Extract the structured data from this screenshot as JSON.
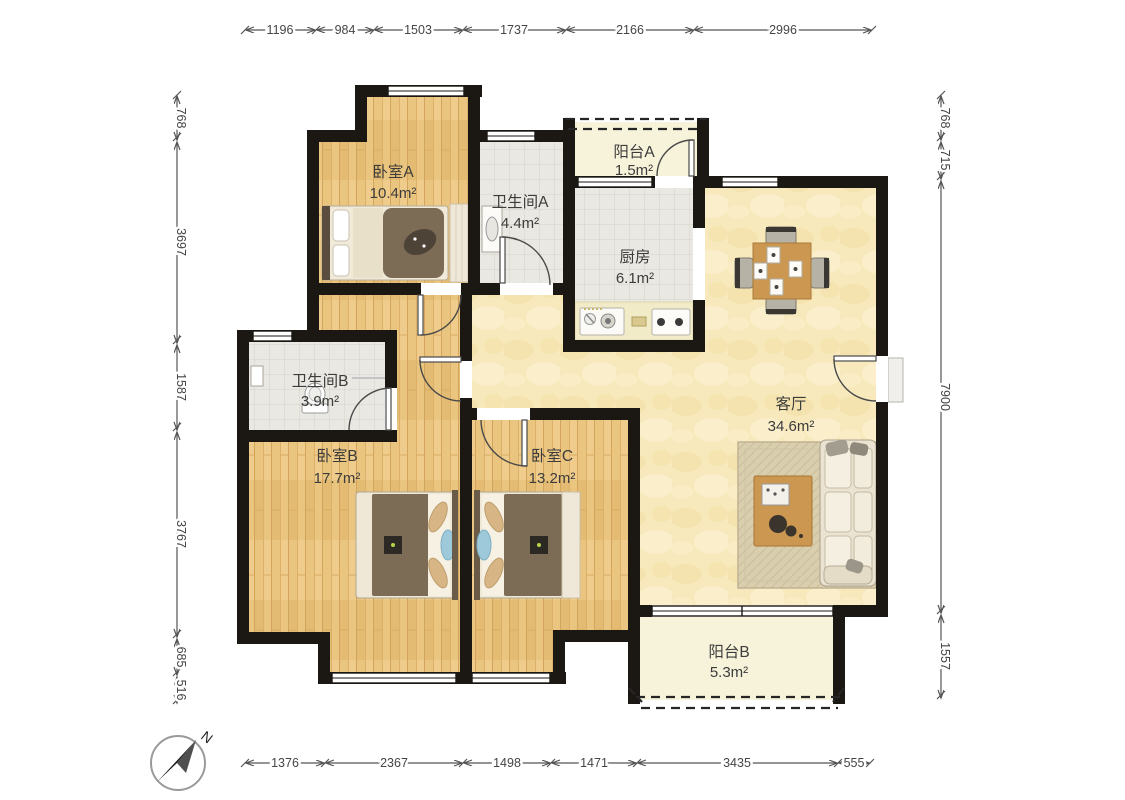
{
  "plan": {
    "type": "apartment-floor-plan",
    "compass": {
      "label": "N"
    },
    "rooms": [
      {
        "id": "bedroom-a",
        "name": "卧室A",
        "area": "10.4m²"
      },
      {
        "id": "bathroom-a",
        "name": "卫生间A",
        "area": "4.4m²"
      },
      {
        "id": "balcony-a",
        "name": "阳台A",
        "area": "1.5m²"
      },
      {
        "id": "kitchen",
        "name": "厨房",
        "area": "6.1m²"
      },
      {
        "id": "living",
        "name": "客厅",
        "area": "34.6m²"
      },
      {
        "id": "bathroom-b",
        "name": "卫生间B",
        "area": "3.9m²"
      },
      {
        "id": "bedroom-b",
        "name": "卧室B",
        "area": "17.7m²"
      },
      {
        "id": "bedroom-c",
        "name": "卧室C",
        "area": "13.2m²"
      },
      {
        "id": "balcony-b",
        "name": "阳台B",
        "area": "5.3m²"
      }
    ],
    "dimensions": {
      "top": [
        "1196",
        "984",
        "1503",
        "1737",
        "2166",
        "2996"
      ],
      "bottom": [
        "1376",
        "2367",
        "1498",
        "1471",
        "3435",
        "555"
      ],
      "left": [
        "768",
        "3697",
        "1587",
        "3767",
        "685",
        "516"
      ],
      "right": [
        "768",
        "715",
        "7900",
        "1557"
      ]
    },
    "colors": {
      "wall": "#1b1713",
      "wood_floor": "#eac57f",
      "living_floor": "#f8e9bd",
      "tile_floor": "#eae8e2",
      "balcony_floor": "#f7f3da",
      "rug": "#d9cead",
      "furniture_wood": "#cb9751",
      "blanket": "#7d6c55"
    }
  }
}
